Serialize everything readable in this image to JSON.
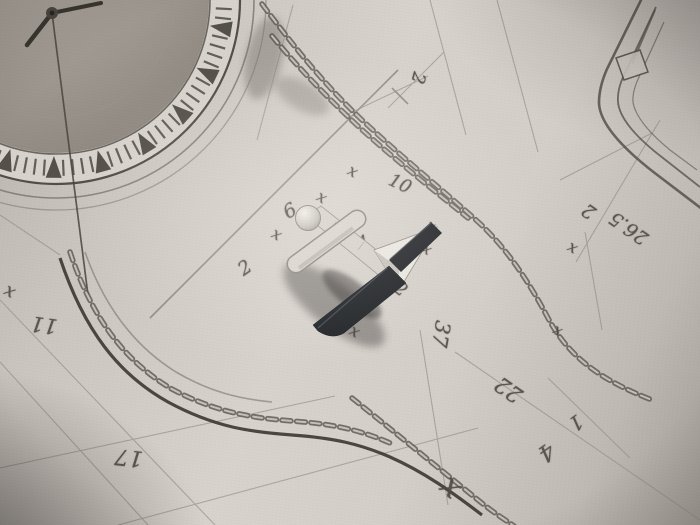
{
  "photo": {
    "colors": {
      "paper": "#d4cfc9",
      "pencil": "#4a453f",
      "metal_bright": "#e8e5df",
      "metal_dark": "#22252a",
      "shadow": "#34312d"
    },
    "annotations": [
      {
        "text": "2",
        "x": 418,
        "y": 78,
        "rot": 105,
        "size": 18
      },
      {
        "text": "2",
        "x": 589,
        "y": 211,
        "rot": 215,
        "size": 19
      },
      {
        "text": "26.5",
        "x": 629,
        "y": 228,
        "rot": 215,
        "size": 19
      },
      {
        "text": "6",
        "x": 290,
        "y": 211,
        "rot": -30,
        "size": 19
      },
      {
        "text": "10",
        "x": 400,
        "y": 184,
        "rot": 25,
        "size": 18
      },
      {
        "text": "2",
        "x": 245,
        "y": 268,
        "rot": -35,
        "size": 19
      },
      {
        "text": "4",
        "x": 363,
        "y": 243,
        "rot": -20,
        "size": 18
      },
      {
        "text": "12",
        "x": 396,
        "y": 286,
        "rot": 38,
        "size": 18
      },
      {
        "text": "37",
        "x": 441,
        "y": 334,
        "rot": 100,
        "size": 21
      },
      {
        "text": "22",
        "x": 509,
        "y": 389,
        "rot": 215,
        "size": 22
      },
      {
        "text": "4",
        "x": 546,
        "y": 452,
        "rot": 145,
        "size": 23
      },
      {
        "text": "1",
        "x": 576,
        "y": 423,
        "rot": 145,
        "size": 20
      },
      {
        "text": "11",
        "x": 44,
        "y": 325,
        "rot": 188,
        "size": 21
      },
      {
        "text": "17",
        "x": 129,
        "y": 457,
        "rot": 186,
        "size": 22
      },
      {
        "text": "x",
        "x": 353,
        "y": 171,
        "rot": 30,
        "size": 16
      },
      {
        "text": "x",
        "x": 322,
        "y": 197,
        "rot": 30,
        "size": 16
      },
      {
        "text": "x",
        "x": 277,
        "y": 234,
        "rot": 30,
        "size": 16
      },
      {
        "text": "x",
        "x": 427,
        "y": 249,
        "rot": 30,
        "size": 15
      },
      {
        "text": "x",
        "x": 431,
        "y": 226,
        "rot": 30,
        "size": 14
      },
      {
        "text": "x",
        "x": 573,
        "y": 247,
        "rot": 30,
        "size": 16
      },
      {
        "text": "x",
        "x": 355,
        "y": 331,
        "rot": 30,
        "size": 16
      },
      {
        "text": "x",
        "x": 558,
        "y": 330,
        "rot": 30,
        "size": 15
      },
      {
        "text": "x",
        "x": 10,
        "y": 291,
        "rot": 30,
        "size": 18
      },
      {
        "text": "x",
        "x": 452,
        "y": 486,
        "rot": 40,
        "size": 32
      }
    ]
  }
}
